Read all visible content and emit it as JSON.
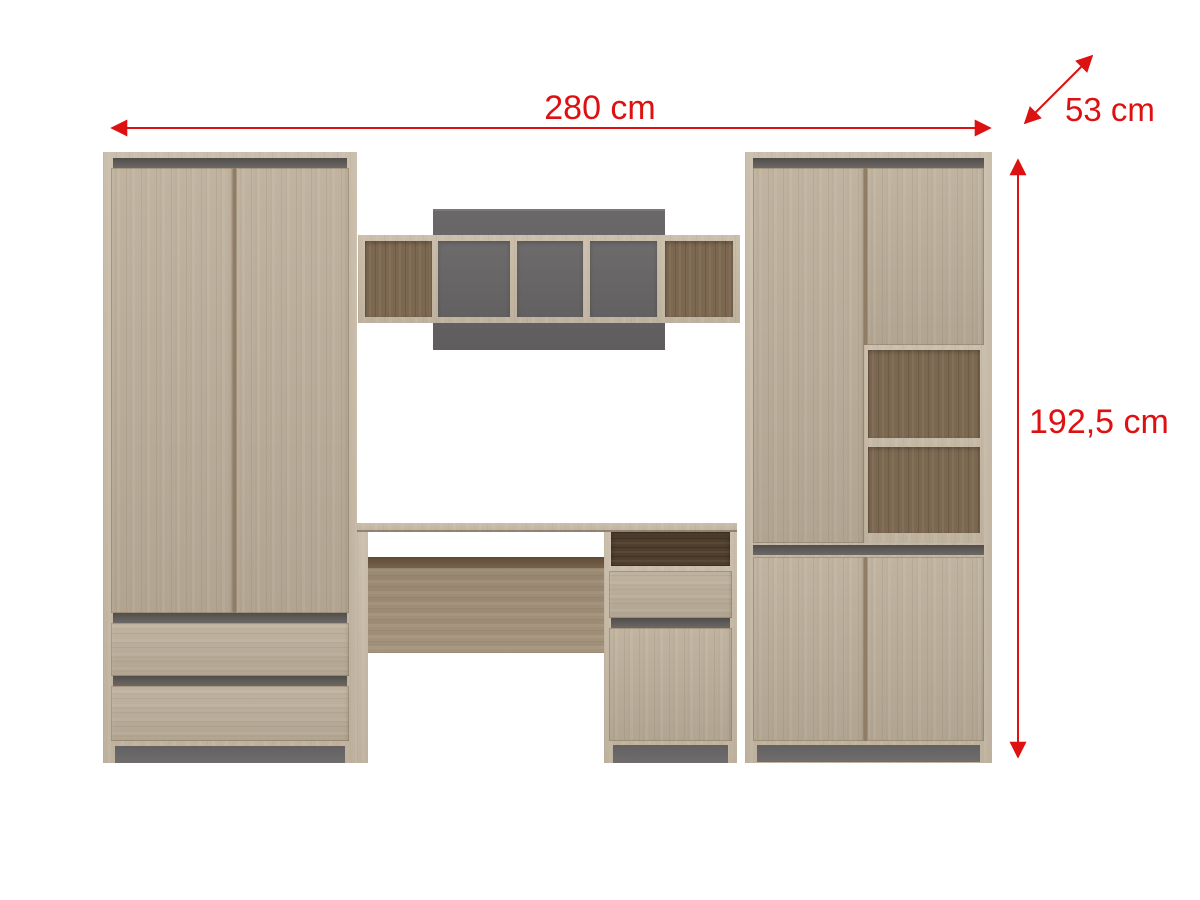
{
  "diagram": {
    "dimension_labels": {
      "width": "280 cm",
      "depth": "53 cm",
      "height": "192,5 cm"
    },
    "colors": {
      "annotation_red": "#dd1111",
      "wood_front": "#bcaf9a",
      "wood_carcass": "#c6b9a5",
      "wood_interior": "#7c6850",
      "wood_dark_niche": "#4f3e2c",
      "accent_gray": "#5b5856",
      "plinth_gray": "#6a6769",
      "back_panel_gray": "#646163",
      "background": "#ffffff"
    }
  }
}
